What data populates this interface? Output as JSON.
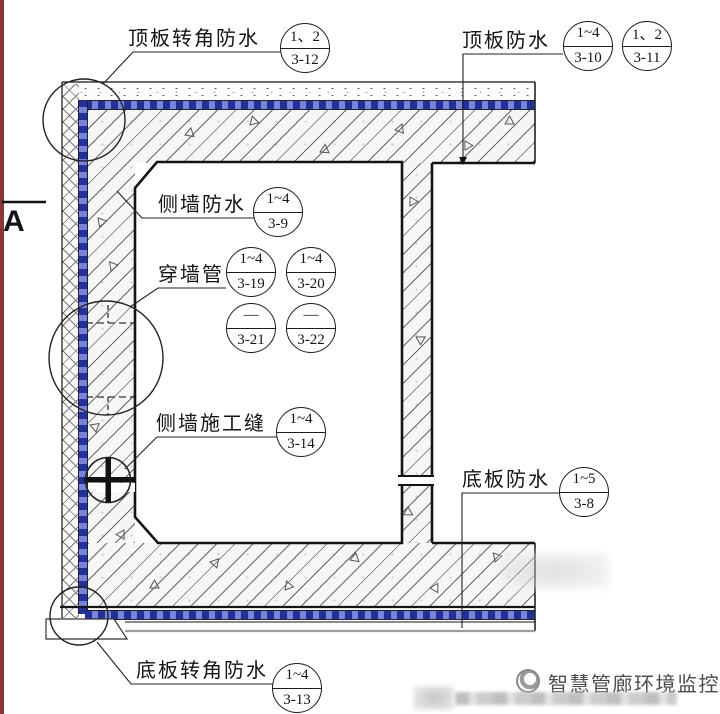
{
  "drawing": {
    "section_marker": "A",
    "labels": {
      "top_corner": {
        "text": "顶板转角防水",
        "callouts": [
          {
            "top": "1、2",
            "bottom": "3-12"
          }
        ]
      },
      "top": {
        "text": "顶板防水",
        "callouts": [
          {
            "top": "1~4",
            "bottom": "3-10"
          },
          {
            "top": "1、2",
            "bottom": "3-11"
          }
        ]
      },
      "side_wall": {
        "text": "侧墙防水",
        "callouts": [
          {
            "top": "1~4",
            "bottom": "3-9"
          }
        ]
      },
      "wall_pipe": {
        "text": "穿墙管",
        "callouts": [
          {
            "top": "1~4",
            "bottom": "3-19"
          },
          {
            "top": "1~4",
            "bottom": "3-20"
          },
          {
            "top": "—",
            "bottom": "3-21"
          },
          {
            "top": "—",
            "bottom": "3-22"
          }
        ]
      },
      "side_wall_joint": {
        "text": "侧墙施工缝",
        "callouts": [
          {
            "top": "1~4",
            "bottom": "3-14"
          }
        ]
      },
      "bottom": {
        "text": "底板防水",
        "callouts": [
          {
            "top": "1~5",
            "bottom": "3-8"
          }
        ]
      },
      "bottom_corner": {
        "text": "底板转角防水",
        "callouts": [
          {
            "top": "1~4",
            "bottom": "3-13"
          }
        ]
      }
    },
    "watermark": {
      "text": "智慧管廊环境监控"
    },
    "colors": {
      "membrane_blue": "#20309d",
      "membrane_light": "#7884d9",
      "hatch_line": "#5f5f5f",
      "cushion_gray": "#9b9b9b",
      "edge_red": "#8a3637"
    }
  }
}
